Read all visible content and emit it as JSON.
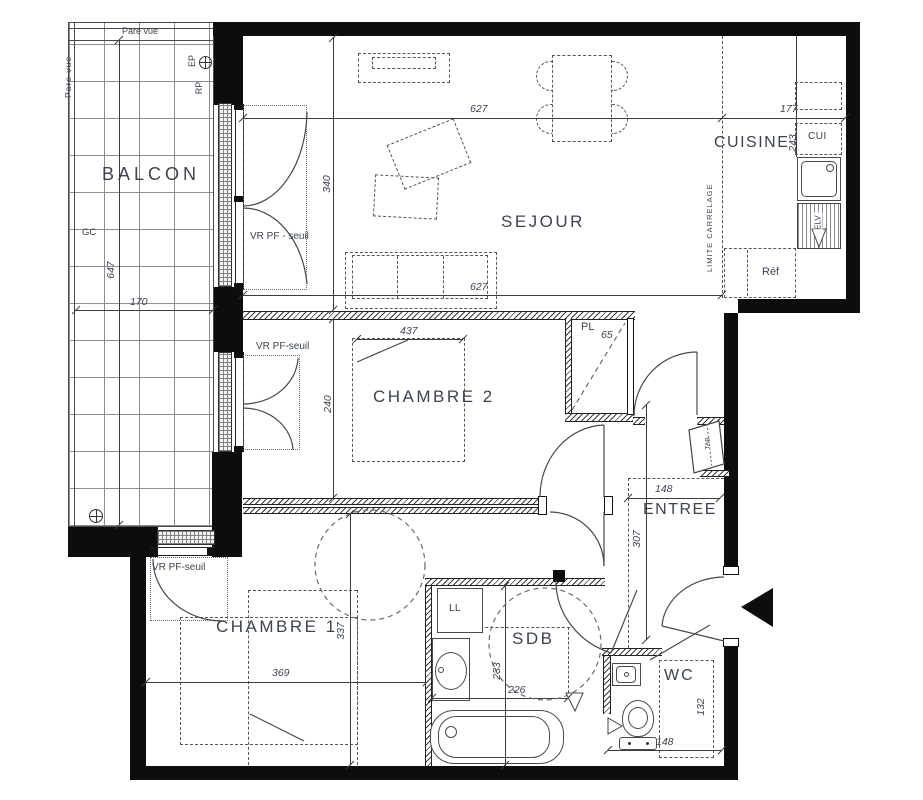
{
  "plan": {
    "rooms": {
      "balcon": "BALCON",
      "sejour": "SEJOUR",
      "cuisine": "CUISINE",
      "chambre2": "CHAMBRE 2",
      "chambre1": "CHAMBRE 1",
      "entree": "ENTREE",
      "sdb": "SDB",
      "wc": "WC"
    },
    "dims": {
      "sejour_width": "627",
      "cuisine_width": "177",
      "sejour_depth": "340",
      "sejour_width_b": "627",
      "balcon_depth": "647",
      "balcon_width": "170",
      "cuisine_depth": "243",
      "ch2_bed": "437",
      "ch2_depth": "240",
      "pl_width": "65",
      "entree_width": "148",
      "entree_depth": "307",
      "ch1_width": "369",
      "ch1_depth": "337",
      "sdb_depth": "233",
      "sdb_width": "226",
      "wc_depth": "132",
      "wc_width": "148"
    },
    "labels": {
      "pare_vue": "Pare vue",
      "ep": "EP",
      "rp": "RP",
      "gc": "GC",
      "vr_pf_seuil_spaced": "VR PF - seuil",
      "vr_pf_seuil": "VR PF-seuil",
      "limite_carrelage": "LIMITE CARRELAGE",
      "cui": "CUI",
      "pl": "PL",
      "ref": "Réf",
      "elv": "ELV",
      "ll": "LL",
      "tab": "TAB"
    }
  }
}
